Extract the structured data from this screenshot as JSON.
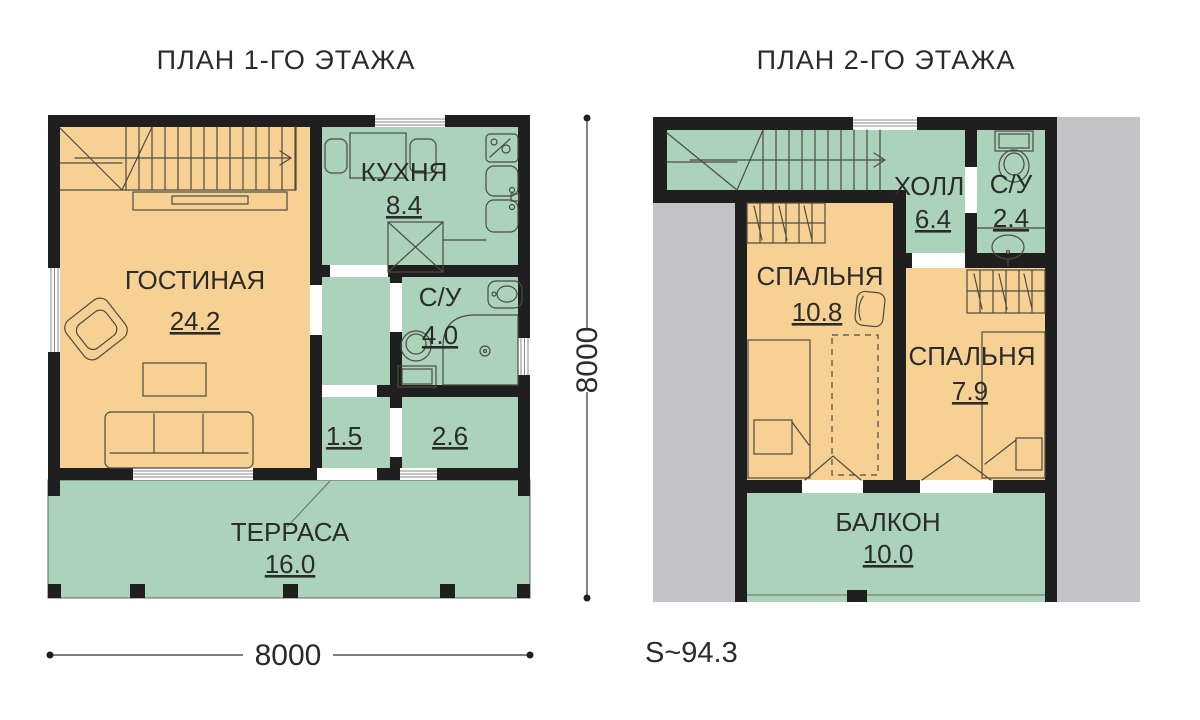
{
  "colors": {
    "wall": "#1f1f1f",
    "room_green": "#abd3ba",
    "room_orange": "#f6d193",
    "roof_gray": "#c3c3c7",
    "furniture_line": "#4e4a42",
    "text": "#2b2b2b"
  },
  "plans": [
    {
      "title": "ПЛАН 1-ГО ЭТАЖА",
      "rooms": [
        {
          "name": "ГОСТИНАЯ",
          "area": "24.2"
        },
        {
          "name": "КУХНЯ",
          "area": "8.4"
        },
        {
          "name": "С/У",
          "area": "4.0"
        },
        {
          "name": "",
          "area": "1.5"
        },
        {
          "name": "",
          "area": "2.6"
        },
        {
          "name": "ТЕРРАСА",
          "area": "16.0"
        }
      ]
    },
    {
      "title": "ПЛАН 2-ГО ЭТАЖА",
      "rooms": [
        {
          "name": "ХОЛЛ",
          "area": "6.4"
        },
        {
          "name": "С/У",
          "area": "2.4"
        },
        {
          "name": "СПАЛЬНЯ",
          "area": "10.8"
        },
        {
          "name": "СПАЛЬНЯ",
          "area": "7.9"
        },
        {
          "name": "БАЛКОН",
          "area": "10.0"
        }
      ]
    }
  ],
  "dimensions": {
    "plan_width": "8000",
    "plan_height": "8000",
    "total_area": "S~94.3"
  }
}
